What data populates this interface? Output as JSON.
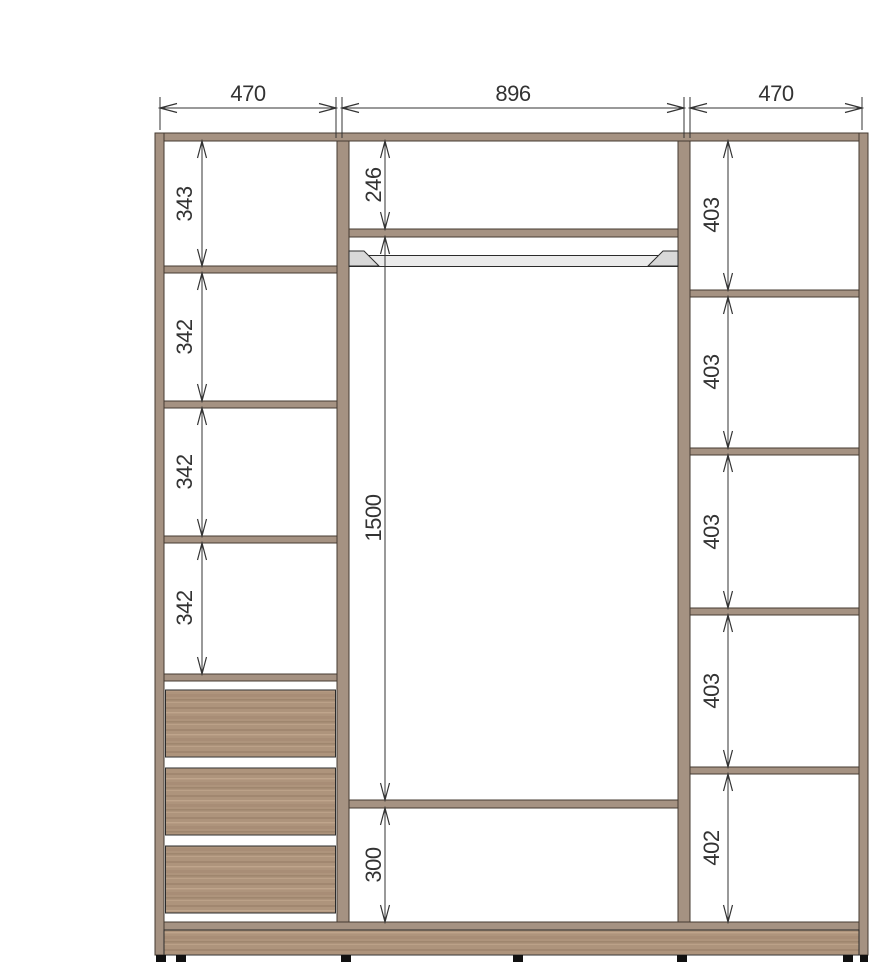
{
  "colors": {
    "background": "#ffffff",
    "panel": "#a59282",
    "panel-edge": "#453b31",
    "wood-base": "#ae947c",
    "wood-dark": "#8a7059",
    "wood-light": "#c7ad93",
    "rod-fill": "#ebebeb",
    "rod-bracket": "#d8d8d8",
    "rod-edge": "#2b2b2b",
    "dim": "#333333",
    "foot": "#111111"
  },
  "dimensions": {
    "top_widths": [
      "470",
      "896",
      "470"
    ],
    "left_sections": [
      "343",
      "342",
      "342",
      "342"
    ],
    "middle_sections": [
      "246",
      "1500",
      "300"
    ],
    "right_sections": [
      "403",
      "403",
      "403",
      "403",
      "402"
    ]
  }
}
